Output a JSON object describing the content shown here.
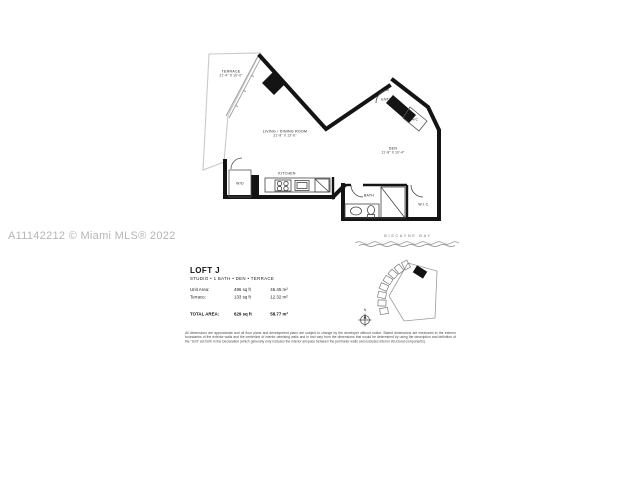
{
  "watermark": {
    "text": "A11142212 © Miami MLS® 2022"
  },
  "floor_plan": {
    "rooms": {
      "terrace": {
        "name": "TERRACE",
        "dims": "21'-4\" X 10'-0\""
      },
      "living": {
        "name": "LIVING / DINING ROOM",
        "dims": "21'-8\" X 13'-6\""
      },
      "den": {
        "name": "DEN",
        "dims": "11'-8\" X 10'-4\""
      },
      "kitchen": {
        "name": "KITCHEN"
      },
      "entry": {
        "name": "ENTRY"
      },
      "ac": {
        "name": "A/C"
      },
      "wd": {
        "name": "W/D"
      },
      "bath": {
        "name": "BATH"
      },
      "wic": {
        "name": "W.I.C."
      }
    }
  },
  "key_plan": {
    "water_label": "BISCAYNE BAY",
    "compass_n": "N"
  },
  "unit_info": {
    "name": "LOFT J",
    "subtitle": "STUDIO • 1 BATH • DEN • TERRACE",
    "rows": [
      {
        "label": "Unit Area:",
        "sqft": "496 sq ft",
        "sqm": "46.45 m²"
      },
      {
        "label": "Terrace:",
        "sqft": "133 sq ft",
        "sqm": "12.32 m²"
      }
    ],
    "total": {
      "label": "TOTAL AREA:",
      "sqft": "629 sq ft",
      "sqm": "58.77 m²"
    }
  },
  "disclaimer": "All dimensions are approximate and all floor plans and development plans are subject to change by the developer without notice. Stated dimensions are measured to the exterior boundaries of the exterior walls and the centerline of interior demising walls and in fact vary from the dimensions that would be determined by using the description and definition of the \"Unit\" set forth in the Declaration (which generally only includes the interior airspace between the perimeter walls and excludes interior structural components)."
}
